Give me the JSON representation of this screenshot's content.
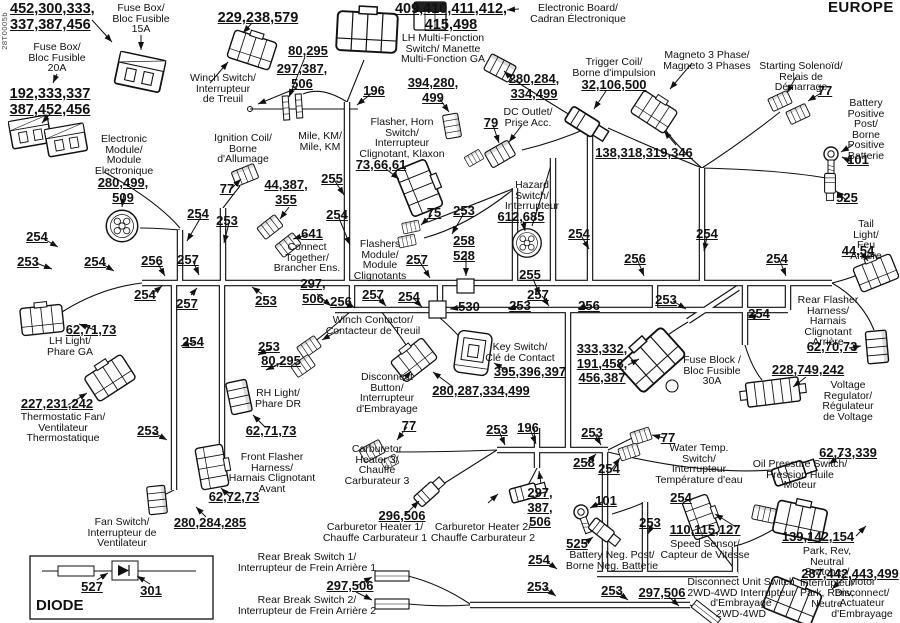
{
  "meta": {
    "title": "EUROPE",
    "code": "28T0005b",
    "ink": "#111111",
    "bg": "#ffffff"
  },
  "diode": {
    "title": "DIODE",
    "num527": "527",
    "num301": "301"
  },
  "labels": {
    "t452": "452,300,333,\n337,387,456",
    "fuse15_name": "Fuse Box/\nBloc Fusible\n15A",
    "winch_nums": "229,238,579",
    "fuse20_name": "Fuse Box/\nBloc Fusible\n20A",
    "fuse20_nums": "192,333,337\n387,452,456",
    "winch_name": "Winch Switch/\nInterrupteur\nde Treuil",
    "mile_nums1": "80,295",
    "mile_nums2": "297,387,\n506",
    "mile_name": "Mile, KM/\nMile, KM",
    "w196a": "196",
    "board_nums": "409,410,411,412,\n415,498",
    "board_name": "Electronic Board/\nCadran Électronique",
    "lhmf_name": "LH Multi-Fonction\nSwitch/ Manette\nMulti-Fonction GA",
    "conn394_nums": "394,280,\n499",
    "ga_nums": "280,284,\n334,499",
    "dc_name": "DC Outlet/\nPrise Acc.",
    "dc_num": "79",
    "trigger_name": "Trigger Coil/\nBorne d'impulsion",
    "trigger_nums": "32,106,500",
    "magneto_name": "Magneto 3 Phase/\nMagneto 3 Phases",
    "magneto_nums": "138,318,319,346",
    "solenoid_name": "Starting Solenoïd/\nRelais de Démarrage",
    "solenoid_num": "77",
    "batpos_name": "Battery\nPositive Post/\nBorne Positive\nBatterie",
    "batpos_num101": "101",
    "batpos_num525": "525",
    "module_name": "Electronic\nModule/\nModule\nElectronique",
    "module_nums": "280,499,\n509",
    "ign_name": "Ignition Coil/\nBorne\nd'Allumage",
    "ign_num": "77",
    "ct_nums": "44,387,\n355",
    "ct_num641": "641",
    "ct_name": "Connect\nTogether/\nBrancher Ens.",
    "fh_name": "Flasher, Horn\nSwitch/\nInterrupteur\nClignotant, Klaxon",
    "fh_nums": "73,66,61",
    "fm_num75": "75",
    "fm_name": "Flashers\nModule/\nModule\nClignotants",
    "hz_name": "Hazard\nSwitch/\nInterrupteur",
    "hz_nums": "612,685",
    "lh_nums": "62,71,73",
    "lh_name": "LH Light/\nPhare GA",
    "tf_nums": "227,231,242",
    "tf_name": "Thermostatic Fan/\nVentilateur\nThermostatique",
    "rh_name": "RH Light/\nPhare DR",
    "rh_nums": "62,71,73",
    "ff_name": "Front Flasher\nHarness/\nHarnais Clignotant\nAvant",
    "ff_nums": "62,72,73",
    "fs_nums": "280,284,285",
    "fs_name": "Fan Switch/\nInterrupteur de\nVentilateur",
    "wc_name": "Winch Contactor/\nContacteur de Treuil",
    "db_name": "Disconnect\nButton/\nInterrupteur\nd'Embrayage",
    "db_nums": "280,287,334,499",
    "ks_name": "Key Switch/\nClé de Contact",
    "ks_nums": "395,396,397",
    "fb_nums": "333,332,\n191,458,\n456,387",
    "fb_name": "Fuse Block /\nBloc Fusible\n30A",
    "ch3_name": "Carburetor\nHeater 3/\nChauffe\nCarburateur 3",
    "ch1_nums": "296,506",
    "ch1_name": "Carburetor Heater 1/\nChauffe Carburateur 1",
    "ch2_name": "Carburetor Heater 2/\nChauffe Carburateur 2",
    "ch2_nums": "297,\n387,\n506",
    "wt_name": "Water Temp.\nSwitch/\nInterrupteur\nTempérature d'eau",
    "op_nums": "62,73,339",
    "op_name": "Oil Pressure Switch/\nPression Huile Moteur",
    "vr_nums": "228,749,242",
    "vr_name": "Voltage Regulator/\nRégulateur\nde Voltage",
    "rf_name": "Rear Flasher\nHarness/\nHarnais Clignotant\nArrière",
    "rf_nums": "62,70,73",
    "tl_name": "Tail Light/\nFeu Arrière",
    "tl_nums": "44,54",
    "bn_num101": "101",
    "bn_num525": "525",
    "bn_name": "Battery Neg. Post/\nBorne Neg. Batterie",
    "ss_nums": "110,115,127",
    "ss_name": "Speed Sensor/\nCapteur de Vitesse",
    "pr_nums": "139,142,154",
    "pr_name": "Park, Rev, Neutral Switches/\nInterrupteur Park, Renv, Neutre",
    "md_nums": "287,442,443,499",
    "md_name": "Motor\nDisconnect/\nActuateur\nd'Embrayage",
    "du_name": "Disconnect Unit Switch\n2WD-4WD Interrupteur\nd'Embrayage\n2WD-4WD",
    "du_nums": "297,506",
    "rb1_name": "Rear Break Switch 1/\nInterrupteur de Frein Arrière 1",
    "rb_nums": "297,506",
    "rb2_name": "Rear Break Switch 2/\nInterrupteur de Frein Arrière 2"
  },
  "wire_callouts": [
    "254",
    "253",
    "254",
    "256",
    "257",
    "254",
    "253",
    "254",
    "257",
    "253",
    "255",
    "254",
    "253",
    "258\n528",
    "255",
    "257",
    "254",
    "256",
    "257",
    "254",
    "530",
    "253",
    "257",
    "256",
    "297,\n506",
    "254",
    "256",
    "254",
    "253",
    "254",
    "254",
    "253",
    "80,295",
    "253",
    "77",
    "253",
    "196",
    "253",
    "77",
    "258",
    "254",
    "254",
    "253",
    "254",
    "253",
    "253"
  ]
}
